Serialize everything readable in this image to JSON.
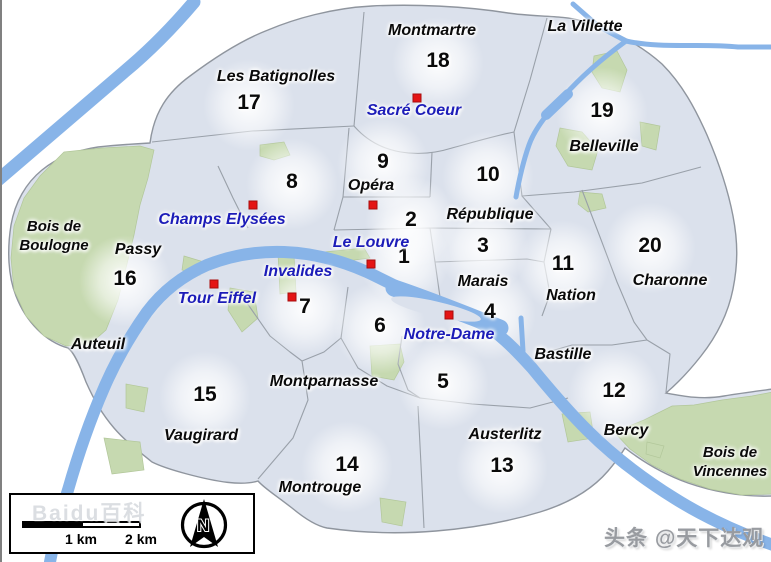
{
  "title": "Paris arrondissements map",
  "colors": {
    "map_fill": "#dbe1ec",
    "map_border": "#8f959e",
    "park_green": "#c6d9b0",
    "river_blue": "#88b4e8",
    "marker_red": "#e41414",
    "landmark_blue": "#1c1cb8",
    "label_black": "#0a0a0a"
  },
  "labels": {
    "numbers": [
      {
        "label": "1",
        "x": 402,
        "y": 257
      },
      {
        "label": "2",
        "x": 409,
        "y": 220
      },
      {
        "label": "3",
        "x": 481,
        "y": 246
      },
      {
        "label": "4",
        "x": 488,
        "y": 312
      },
      {
        "label": "5",
        "x": 441,
        "y": 382
      },
      {
        "label": "6",
        "x": 378,
        "y": 326
      },
      {
        "label": "7",
        "x": 303,
        "y": 307
      },
      {
        "label": "8",
        "x": 290,
        "y": 182
      },
      {
        "label": "9",
        "x": 381,
        "y": 162
      },
      {
        "label": "10",
        "x": 486,
        "y": 175
      },
      {
        "label": "11",
        "x": 561,
        "y": 264
      },
      {
        "label": "12",
        "x": 612,
        "y": 391
      },
      {
        "label": "13",
        "x": 500,
        "y": 466
      },
      {
        "label": "14",
        "x": 345,
        "y": 465
      },
      {
        "label": "15",
        "x": 203,
        "y": 395
      },
      {
        "label": "16",
        "x": 123,
        "y": 279
      },
      {
        "label": "17",
        "x": 247,
        "y": 103
      },
      {
        "label": "18",
        "x": 436,
        "y": 61
      },
      {
        "label": "19",
        "x": 600,
        "y": 111
      },
      {
        "label": "20",
        "x": 648,
        "y": 246
      }
    ],
    "districts": [
      {
        "label": "Montmartre",
        "x": 430,
        "y": 31
      },
      {
        "label": "La Villette",
        "x": 583,
        "y": 27
      },
      {
        "label": "Les Batignolles",
        "x": 274,
        "y": 77
      },
      {
        "label": "Belleville",
        "x": 602,
        "y": 147
      },
      {
        "label": "Opéra",
        "x": 369,
        "y": 186
      },
      {
        "label": "République",
        "x": 488,
        "y": 215
      },
      {
        "label": "Passy",
        "x": 136,
        "y": 250
      },
      {
        "label": "Marais",
        "x": 481,
        "y": 282
      },
      {
        "label": "Nation",
        "x": 569,
        "y": 296
      },
      {
        "label": "Charonne",
        "x": 668,
        "y": 281
      },
      {
        "label": "Auteuil",
        "x": 96,
        "y": 345
      },
      {
        "label": "Bastille",
        "x": 561,
        "y": 355
      },
      {
        "label": "Montparnasse",
        "x": 322,
        "y": 382
      },
      {
        "label": "Vaugirard",
        "x": 199,
        "y": 436
      },
      {
        "label": "Austerlitz",
        "x": 503,
        "y": 435
      },
      {
        "label": "Bercy",
        "x": 624,
        "y": 431
      },
      {
        "label": "Montrouge",
        "x": 318,
        "y": 488
      }
    ],
    "landmarks": [
      {
        "label": "Sacré Coeur",
        "x": 412,
        "y": 111
      },
      {
        "label": "Champs Elysées",
        "x": 220,
        "y": 220
      },
      {
        "label": "Le Louvre",
        "x": 369,
        "y": 243
      },
      {
        "label": "Invalides",
        "x": 296,
        "y": 272
      },
      {
        "label": "Tour Eiffel",
        "x": 215,
        "y": 299
      },
      {
        "label": "Notre-Dame",
        "x": 447,
        "y": 335
      }
    ],
    "woods": [
      {
        "lines": [
          "Bois de",
          "Boulogne"
        ],
        "x": 52,
        "y": 236
      },
      {
        "lines": [
          "Bois de",
          "Vincennes"
        ],
        "x": 728,
        "y": 462
      }
    ]
  },
  "markers": [
    {
      "for": "Sacré Coeur",
      "x": 415,
      "y": 98
    },
    {
      "for": "Opéra",
      "x": 371,
      "y": 205
    },
    {
      "for": "Champs Elysées",
      "x": 251,
      "y": 205
    },
    {
      "for": "Le Louvre",
      "x": 369,
      "y": 264
    },
    {
      "for": "Invalides",
      "x": 290,
      "y": 297
    },
    {
      "for": "Tour Eiffel",
      "x": 212,
      "y": 284
    },
    {
      "for": "Notre-Dame",
      "x": 447,
      "y": 315
    }
  ],
  "legend": {
    "scale_km_1": "1 km",
    "scale_km_2": "2 km",
    "compass_n": "N"
  },
  "watermarks": {
    "left": "Baidu百科",
    "right": "头条 @天下达观"
  }
}
